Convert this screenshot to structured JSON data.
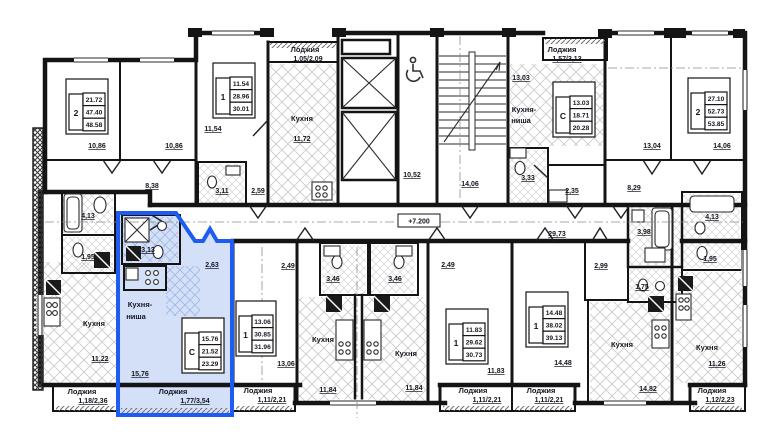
{
  "title": "Этажный план — типовой этаж с выделенной квартирой-студией",
  "level_mark": "+7.200",
  "colors": {
    "highlight_stroke": "#1e5bf0",
    "highlight_fill": "#d3e0f8",
    "wall": "#141414"
  },
  "strings": {
    "kitchen": "Кухня",
    "kitchen_niche_l1": "Кухня-",
    "kitchen_niche_l2": "ниша",
    "loggia": "Лоджия"
  },
  "corridor": {
    "main": "29,73",
    "upper": "10,52",
    "stair_lobby": "14,06"
  },
  "apartments": {
    "a2_tl": {
      "num": "2",
      "t": [
        "21.72",
        "47.40",
        "48.58"
      ],
      "room1": "10,86",
      "room2": "10,86",
      "hall": "8,38"
    },
    "a1_tm": {
      "num": "1",
      "t": [
        "11.54",
        "28.96",
        "30.01"
      ],
      "room": "11,54",
      "bath": "3,11",
      "hall": "2,59",
      "kitchen": "11,72",
      "loggia": "1,05/2,09"
    },
    "ac_tr": {
      "num": "С",
      "t": [
        "13.03",
        "18.71",
        "20.28"
      ],
      "room": "13,03",
      "bath": "3,33",
      "hall": "2,35",
      "loggia": "1,57/3,13"
    },
    "a2_tr": {
      "num": "2",
      "t": [
        "27.10",
        "52.73",
        "53.85"
      ],
      "room1": "13,04",
      "room2": "14,06",
      "hall": "8,29"
    },
    "left_bottom": {
      "kitchen": "11,22",
      "bath": "4,13",
      "wc": "1,95",
      "loggia": "1,18/2,36"
    },
    "studio_highlight": {
      "num": "С",
      "t": [
        "15.76",
        "21.52",
        "23.29"
      ],
      "room": "15,76",
      "bath": "3,13",
      "hall": "2,63",
      "loggia": "1,77/3,54"
    },
    "a1_bml": {
      "num": "1",
      "t": [
        "13.06",
        "30.85",
        "31.96"
      ],
      "room": "13,06",
      "bath": "3,46",
      "hall": "2,49",
      "kitchen": "11,84",
      "loggia": "1,11/2,21"
    },
    "a1_bmr": {
      "num": "1",
      "t": [
        "11.83",
        "29.62",
        "30.73"
      ],
      "room": "11,83",
      "bath": "3,46",
      "hall": "2,49",
      "kitchen": "11,84",
      "loggia": "1,11/2,21"
    },
    "a1_br": {
      "num": "1",
      "t": [
        "14.48",
        "38.02",
        "39.13"
      ],
      "room": "14,48",
      "bath": "3,98",
      "wc": "1,75",
      "hall": "2,99",
      "kitchen": "14,82",
      "loggia": "1,11/2,21"
    },
    "right_bottom": {
      "kitchen": "11,26",
      "bath": "4,13",
      "wc": "1,95",
      "loggia": "1,12/2,23"
    }
  }
}
